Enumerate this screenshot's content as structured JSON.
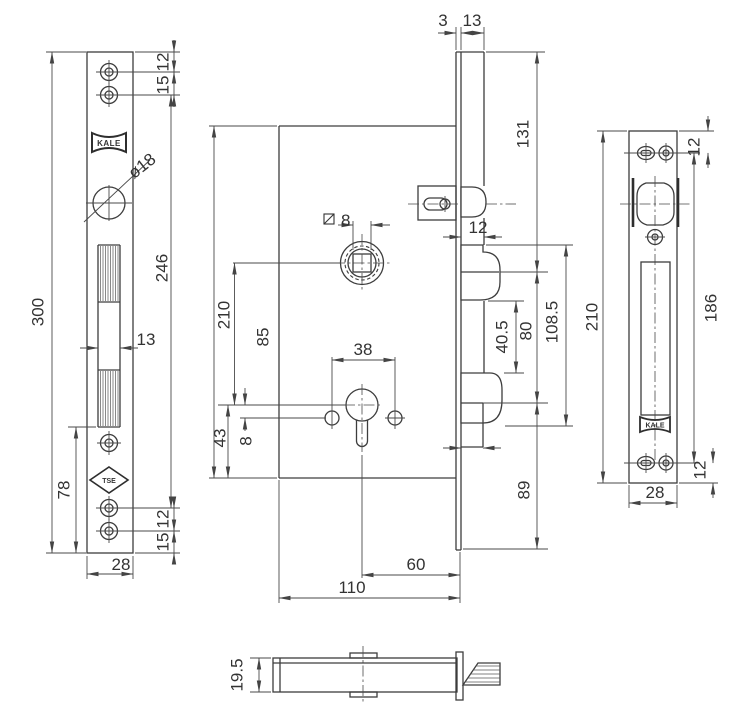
{
  "drawing": {
    "brand": "KALE",
    "front_plate": {
      "logos": {
        "kale": "KALE",
        "tse": "TSE"
      },
      "dims": {
        "total_height": "300",
        "bottom_section": "78",
        "screw_span": "246",
        "width": "28",
        "bolt_width": "13",
        "top_edge_offset": "12",
        "top_screw_gap": "15",
        "bottom_screw_gap": "12",
        "bottom_edge_offset": "15",
        "hole_diameter": "ø18"
      }
    },
    "lock_body": {
      "dims": {
        "height": "210",
        "follower_to_cylinder": "85",
        "cylinder_to_bottom": "43",
        "hole_offset": "8",
        "fixing_hole_span": "38",
        "backset": "60",
        "depth": "110",
        "square_spindle": "8"
      }
    },
    "side_view": {
      "dims": {
        "faceplate_thickness": "3",
        "body_thickness": "13",
        "latch_position": "131",
        "latch_protrusion": "12",
        "hook_gap": "40.5",
        "hook_pitch": "80",
        "hook_outer_span": "108.5",
        "bottom_section": "89"
      }
    },
    "strike_plate": {
      "logos": {
        "kale": "KALE"
      },
      "dims": {
        "height": "210",
        "screw_span": "186",
        "width": "28",
        "top_offset": "12",
        "bottom_offset": "12"
      }
    },
    "bottom_view": {
      "dims": {
        "thickness": "19.5"
      }
    }
  }
}
